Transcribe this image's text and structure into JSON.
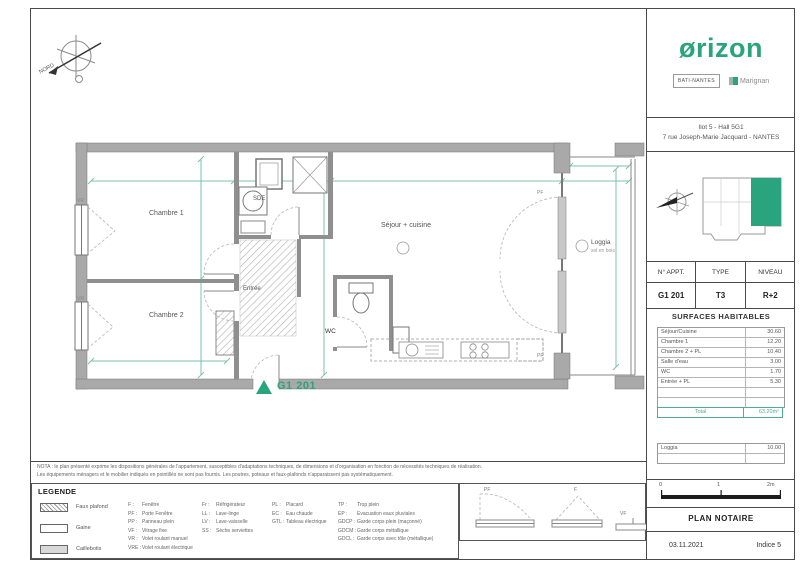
{
  "colors": {
    "green": "#2aa47c",
    "dim_green": "#7cc3ab",
    "wall_gray": "#a9a9a9"
  },
  "branding": {
    "logo": "ørizon",
    "partner1": "BATI-NANTES",
    "partner2": "Marignan"
  },
  "project": {
    "line1": "Ilot 5 - Hall 5G1",
    "line2": "7 rue Joseph-Marie Jacquard - NANTES"
  },
  "apartment": {
    "headers": [
      "N° APPT.",
      "TYPE",
      "NIVEAU"
    ],
    "values": [
      "G1 201",
      "T3",
      "R+2"
    ]
  },
  "surfaces": {
    "title": "SURFACES HABITABLES",
    "rows": [
      {
        "label": "Séjour/Cuisine",
        "value": "30.60"
      },
      {
        "label": "Chambre 1",
        "value": "12.20"
      },
      {
        "label": "Chambre 2 + PL",
        "value": "10.40"
      },
      {
        "label": "Salle d'eau",
        "value": "3.00"
      },
      {
        "label": "WC",
        "value": "1.70"
      },
      {
        "label": "Entrée + PL",
        "value": "5.30"
      },
      {
        "label": "",
        "value": ""
      },
      {
        "label": "",
        "value": ""
      }
    ],
    "total_label": "Total",
    "total_value": "63.20m²",
    "annex_rows": [
      {
        "label": "Loggia",
        "value": "10.00"
      },
      {
        "label": "",
        "value": ""
      }
    ]
  },
  "plan": {
    "north": "NORD",
    "rooms": {
      "chambre1": "Chambre 1",
      "chambre2": "Chambre 2",
      "sde": "SDE",
      "entree": "Entrée",
      "wc": "WC",
      "sejour": "Séjour + cuisine",
      "loggia": "Loggia",
      "loggia_sub": "sol en bois"
    },
    "unit_label": "G1 201",
    "tags": {
      "vr": "VR",
      "pf": "PF"
    }
  },
  "nota": {
    "line1": "NOTA : le plan présenté exprime les dispositions générales de l'appartement, susceptibles d'adaptations techniques, de dimensions et d'organisation en fonction de nécessités techniques de réalisation.",
    "line2": "Les équipements ménagers et le mobilier indiqués en pointillés ne sont pas fournis. Les poutres, poteaux et faux-plafonds n'apparaissent pas systématiquement."
  },
  "legend": {
    "title": "LEGENDE",
    "swatches": [
      {
        "label": "Faux plafond"
      },
      {
        "label": "Gaine"
      },
      {
        "label": "Caillebotis"
      }
    ],
    "col1": [
      {
        "code": "F :",
        "label": "Fenêtre"
      },
      {
        "code": "PF :",
        "label": "Porte Fenêtre"
      },
      {
        "code": "PP :",
        "label": "Panneau plein"
      },
      {
        "code": "VF :",
        "label": "Vitrage fixe"
      },
      {
        "code": "VR :",
        "label": "Volet roulant manuel"
      },
      {
        "code": "VRE :",
        "label": "Volet roulant électrique"
      }
    ],
    "col2": [
      {
        "code": "Fr :",
        "label": "Réfrigérateur"
      },
      {
        "code": "LL :",
        "label": "Lave-linge"
      },
      {
        "code": "LV :",
        "label": "Lave-vaisselle"
      },
      {
        "code": "SS :",
        "label": "Sèche serviettes"
      }
    ],
    "col3": [
      {
        "code": "PL :",
        "label": "Placard"
      },
      {
        "code": "EC :",
        "label": "Eau chaude"
      },
      {
        "code": "GTL :",
        "label": "Tableau électrique"
      }
    ],
    "col4": [
      {
        "code": "TP :",
        "label": "Trop plein"
      },
      {
        "code": "EP :",
        "label": "Evacuation eaux pluviales"
      },
      {
        "code": "GDCP :",
        "label": "Garde corps plein (maçonné)"
      },
      {
        "code": "GDCM :",
        "label": "Garde corps métallique"
      },
      {
        "code": "GDCL :",
        "label": "Garde corps avec tôle (métallique)"
      }
    ],
    "window_symbols": [
      "PF",
      "F",
      "VF"
    ]
  },
  "titleblock": {
    "scale_labels": [
      "0",
      "1",
      "2m"
    ],
    "title": "PLAN NOTAIRE",
    "date": "03.11.2021",
    "indice": "Indice 5"
  }
}
